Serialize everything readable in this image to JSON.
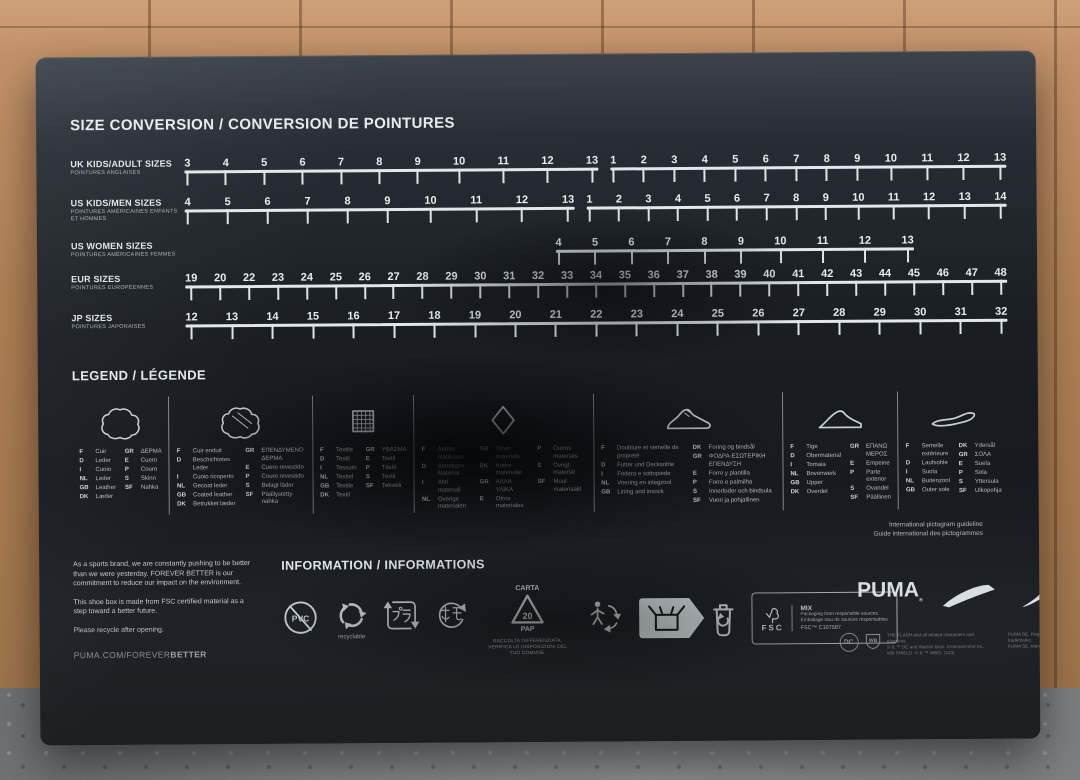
{
  "size_chart": {
    "title": "SIZE CONVERSION / CONVERSION DE POINTURES",
    "rows": [
      {
        "label": "UK KIDS/ADULT SIZES",
        "sublabel": "POINTURES ANGLAISES",
        "segments": [
          [
            "3",
            "4",
            "5",
            "6",
            "7",
            "8",
            "9",
            "10",
            "11",
            "12",
            "13"
          ],
          [
            "1",
            "2",
            "3",
            "4",
            "5",
            "6",
            "7",
            "8",
            "9",
            "10",
            "11",
            "12",
            "13"
          ]
        ]
      },
      {
        "label": "US KIDS/MEN SIZES",
        "sublabel": "POINTURES AMÉRICAINES ENFANTS ET HOMMES",
        "segments": [
          [
            "4",
            "5",
            "6",
            "7",
            "8",
            "9",
            "10",
            "11",
            "12",
            "13"
          ],
          [
            "1",
            "2",
            "3",
            "4",
            "5",
            "6",
            "7",
            "8",
            "9",
            "10",
            "11",
            "12",
            "13",
            "14"
          ]
        ]
      },
      {
        "label": "US WOMEN SIZES",
        "sublabel": "POINTURES AMÉRICAINES FEMMES",
        "segments": [
          [
            "4",
            "5",
            "6",
            "7",
            "8",
            "9",
            "10",
            "11",
            "12",
            "13"
          ]
        ]
      },
      {
        "label": "EUR SIZES",
        "sublabel": "POINTURES EUROPÉENNES",
        "segments": [
          [
            "19",
            "20",
            "22",
            "23",
            "24",
            "25",
            "26",
            "27",
            "28",
            "29",
            "30",
            "31",
            "32",
            "33",
            "34",
            "35",
            "36",
            "37",
            "38",
            "39",
            "40",
            "41",
            "42",
            "43",
            "44",
            "45",
            "46",
            "47",
            "48"
          ]
        ]
      },
      {
        "label": "JP SIZES",
        "sublabel": "POINTURES JAPONAISES",
        "segments": [
          [
            "12",
            "13",
            "14",
            "15",
            "16",
            "17",
            "18",
            "19",
            "20",
            "21",
            "22",
            "23",
            "24",
            "25",
            "26",
            "27",
            "28",
            "29",
            "30",
            "31",
            "32"
          ]
        ]
      }
    ]
  },
  "legend": {
    "title": "LEGEND / LÉGENDE",
    "items": [
      {
        "name": "leather",
        "icon": "leather-hide-icon",
        "lists": [
          [
            [
              "F",
              "Cuir"
            ],
            [
              "D",
              "Leder"
            ],
            [
              "I",
              "Cuoio"
            ],
            [
              "NL",
              "Leder"
            ],
            [
              "GB",
              "Leather"
            ],
            [
              "DK",
              "Læder"
            ]
          ],
          [
            [
              "GR",
              "ΔΕΡΜΑ"
            ],
            [
              "E",
              "Cuero"
            ],
            [
              "P",
              "Couro"
            ],
            [
              "S",
              "Skinn"
            ],
            [
              "SF",
              "Nahka"
            ]
          ]
        ]
      },
      {
        "name": "coated-leather",
        "icon": "coated-leather-icon",
        "lists": [
          [
            [
              "F",
              "Cuir enduit"
            ],
            [
              "D",
              "Beschichtetes Leder"
            ],
            [
              "I",
              "Cuoio ricoperto"
            ],
            [
              "NL",
              "Gecoat leder"
            ],
            [
              "GB",
              "Coated leather"
            ],
            [
              "DK",
              "Betrukket læder"
            ]
          ],
          [
            [
              "GR",
              "ΕΠΕΝΔΥΜΕΝΟ ΔΕΡΜΑ"
            ],
            [
              "E",
              "Cuero revestido"
            ],
            [
              "P",
              "Couro revestido"
            ],
            [
              "S",
              "Belagt läder"
            ],
            [
              "SF",
              "Päällystetty nahka"
            ]
          ]
        ]
      },
      {
        "name": "textile",
        "icon": "textile-icon",
        "lists": [
          [
            [
              "F",
              "Textile"
            ],
            [
              "D",
              "Textil"
            ],
            [
              "I",
              "Tessuto"
            ],
            [
              "NL",
              "Textiel"
            ],
            [
              "GB",
              "Textile"
            ],
            [
              "DK",
              "Textil"
            ]
          ],
          [
            [
              "GR",
              "ΥΦΑΣΜΑ"
            ],
            [
              "E",
              "Textil"
            ],
            [
              "P",
              "Têxtil"
            ],
            [
              "S",
              "Textil"
            ],
            [
              "SF",
              "Tekstiili"
            ]
          ]
        ]
      },
      {
        "name": "other-materials",
        "icon": "other-materials-icon",
        "lists": [
          [
            [
              "F",
              "Autres matériaux"
            ],
            [
              "D",
              "Sonstiges Material"
            ],
            [
              "I",
              "Altri materiali"
            ],
            [
              "NL",
              "Overige materialen"
            ]
          ],
          [
            [
              "GB",
              "Other materials"
            ],
            [
              "DK",
              "Andre materialer"
            ],
            [
              "GR",
              "ΑΛΛΑ ΥΛΙΚΑ"
            ],
            [
              "E",
              "Otros materiales"
            ]
          ],
          [
            [
              "P",
              "Outros materiais"
            ],
            [
              "S",
              "Övrigt material"
            ],
            [
              "SF",
              "Muut materiaalit"
            ]
          ]
        ]
      },
      {
        "name": "lining-insock",
        "icon": "lining-shoe-icon",
        "lists": [
          [
            [
              "F",
              "Doublure et semelle de propreté"
            ],
            [
              "D",
              "Futter und Decksohle"
            ],
            [
              "I",
              "Fodera e sottopiede"
            ],
            [
              "NL",
              "Voering en inlegzool"
            ],
            [
              "GB",
              "Lining and insock"
            ]
          ],
          [
            [
              "DK",
              "Foring og bindsål"
            ],
            [
              "GR",
              "ΦΟΔΡΑ-ΕΣΩΤΕΡΙΚΗ ΕΠΕΝΔΥΣΗ"
            ],
            [
              "E",
              "Forro y plantilla"
            ],
            [
              "P",
              "Forro e palmilha"
            ],
            [
              "S",
              "Innerfoder och bindsula"
            ],
            [
              "SF",
              "Vuori ja pohjallinen"
            ]
          ]
        ]
      },
      {
        "name": "upper",
        "icon": "upper-shoe-icon",
        "lists": [
          [
            [
              "F",
              "Tige"
            ],
            [
              "D",
              "Obermaterial"
            ],
            [
              "I",
              "Tomaia"
            ],
            [
              "NL",
              "Bovenwerk"
            ],
            [
              "GB",
              "Upper"
            ],
            [
              "DK",
              "Overdel"
            ]
          ],
          [
            [
              "GR",
              "ΕΠΑΝΩ ΜΕΡΟΣ"
            ],
            [
              "E",
              "Empeine"
            ],
            [
              "P",
              "Parte exterior"
            ],
            [
              "S",
              "Ovandel"
            ],
            [
              "SF",
              "Päällinen"
            ]
          ]
        ]
      },
      {
        "name": "outer-sole",
        "icon": "outer-sole-icon",
        "lists": [
          [
            [
              "F",
              "Semelle extérieure"
            ],
            [
              "D",
              "Laufsohle"
            ],
            [
              "I",
              "Suola"
            ],
            [
              "NL",
              "Buitenzool"
            ],
            [
              "GB",
              "Outer sole"
            ]
          ],
          [
            [
              "DK",
              "Ydersål"
            ],
            [
              "GR",
              "ΣΟΛΑ"
            ],
            [
              "E",
              "Suela"
            ],
            [
              "P",
              "Sola"
            ],
            [
              "S",
              "Yttersula"
            ],
            [
              "SF",
              "Ulkopohja"
            ]
          ]
        ]
      }
    ],
    "note_line1": "International pictogram guideline",
    "note_line2": "Guide international des pictogrammes"
  },
  "sustainability_note": {
    "p1": "As a sports brand, we are constantly pushing to be better than we were yesterday. FOREVER BETTER is our commitment to reduce our impact on the environment.",
    "p2": "This shoe box is made from FSC certified material as a step toward a better future.",
    "p3": "Please recycle after opening.",
    "url_regular": "PUMA.COM/FOREVER",
    "url_bold": "BETTER"
  },
  "information": {
    "title": "INFORMATION / INFORMATIONS",
    "pvc_label": "PVC",
    "recyclable_label": "recyclable",
    "pla_mark_text": "プラ",
    "kami_mark_text": "紙",
    "paper_top": "CARTA",
    "paper_num": "20",
    "paper_bottom": "PAP",
    "paper_note": "RACCOLTA DIFFERENZIATA. VERIFICA LE DISPOSIZIONI DEL TUO COMUNE.",
    "fsc": {
      "brand": "FSC",
      "mix": "MIX",
      "line1": "Packaging from responsible sources.",
      "line2": "Emballage issu de sources responsables",
      "code": "FSC™ C107587"
    }
  },
  "branding": {
    "wordmark": "PUMA",
    "reg": "®",
    "dc": "DC",
    "wb": "WB",
    "legal1": "THE FLASH and all related characters and elements",
    "legal2": "© & ™ DC and Warner Bros. Entertainment Inc.",
    "legal3": "WB SHIELD: © & ™ WBEI. (s23)",
    "legal_right1": "PUMA SE, Registered trademarks.",
    "legal_right2": "PUMA SE, Marque déposée."
  }
}
